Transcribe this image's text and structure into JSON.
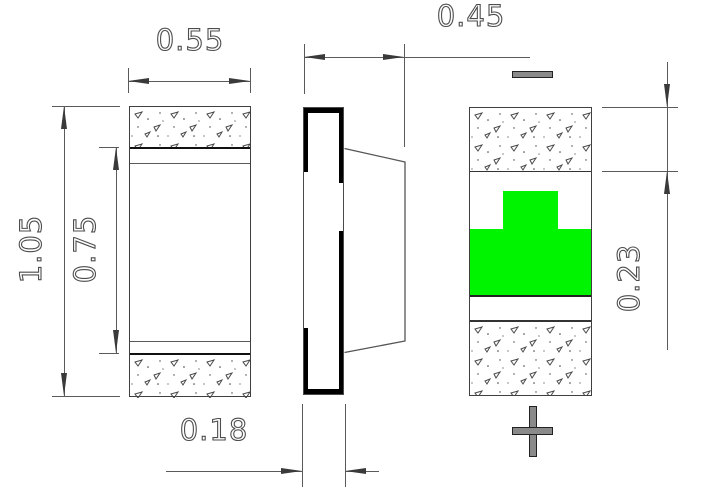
{
  "drawing": {
    "dimensions": {
      "front_width": "0.55",
      "front_total_height": "1.05",
      "front_inner_height": "0.75",
      "side_depth": "0.45",
      "side_thickness": "0.18",
      "back_terminal_height": "0.23"
    },
    "polarity": {
      "top_mark": "minus",
      "bottom_mark": "plus"
    },
    "colors": {
      "emitter_green": "#00f400",
      "outline_gray": "#3f3f3f",
      "dimension_gray": "#5a5a5a"
    }
  }
}
